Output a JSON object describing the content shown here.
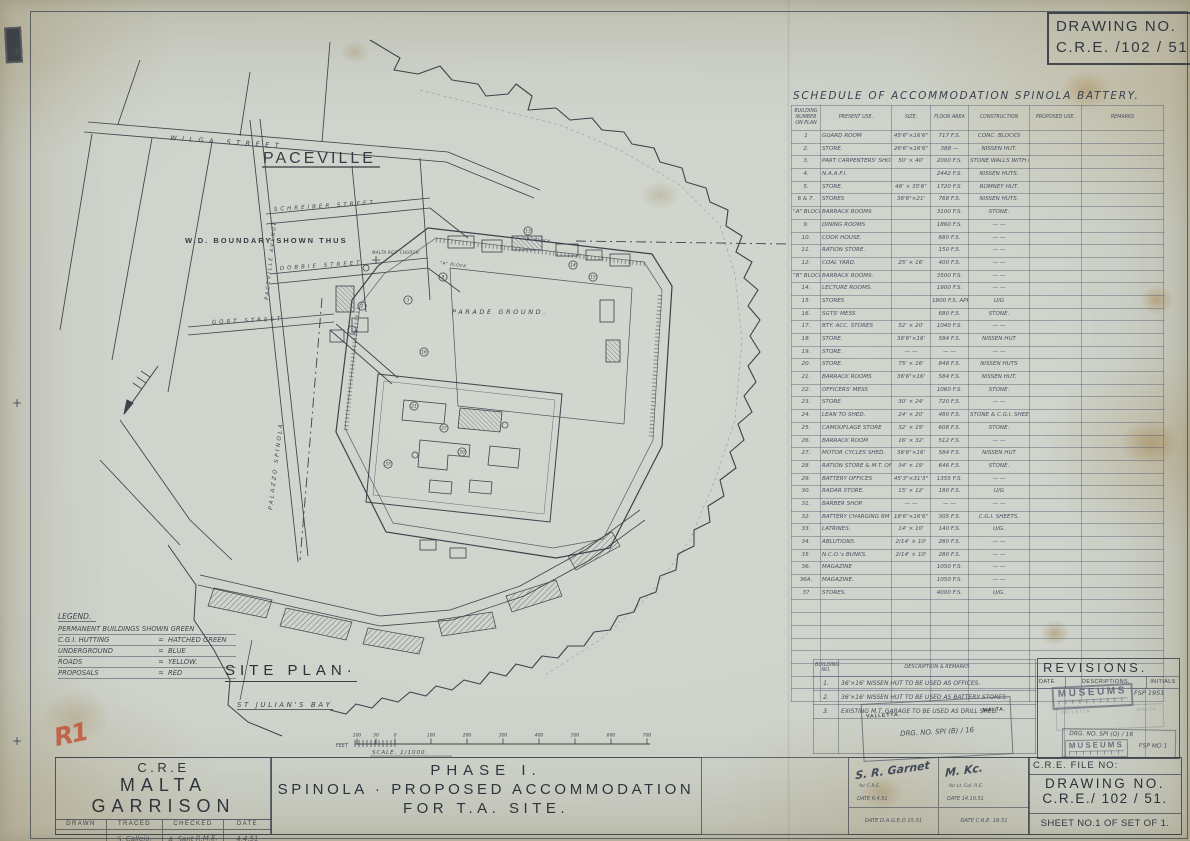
{
  "drawing_no_header": {
    "line1": "DRAWING NO.",
    "line2": "C.R.E. /102 / 51."
  },
  "schedule": {
    "title": "SCHEDULE OF ACCOMMODATION SPINOLA BATTERY.",
    "columns": [
      "BUILDING NUMBER ON PLAN",
      "PRESENT USE.",
      "SIZE.",
      "FLOOR AREA",
      "CONSTRUCTION",
      "PROPOSED USE.",
      "REMARKS"
    ],
    "rows": [
      {
        "n": "1",
        "u": "GUARD ROOM",
        "s": "45'6\"×16'6\"",
        "a": "717 F.S.",
        "c": "CONC. BLOCKS"
      },
      {
        "n": "2.",
        "u": "STORE.",
        "s": "26'6\"×16'6\"",
        "a": "388  —",
        "c": "NISSEN HUT."
      },
      {
        "n": "3.",
        "u": "PART CARPENTERS' SHOP & PART CUBICLES",
        "s": "50' × 40'",
        "a": "2000 F.S.",
        "c": "STONE WALLS WITH C.G.I. SHEETS ROOF"
      },
      {
        "n": "4.",
        "u": "N.A.A.F.I.",
        "s": "",
        "a": "2442 F.S.",
        "c": "NISSEN HUTS."
      },
      {
        "n": "5.",
        "u": "STORE.",
        "s": "48' × 35'6\"",
        "a": "1720 F.S.",
        "c": "ROMNEY HUT."
      },
      {
        "n": "6 & 7.",
        "u": "STORES",
        "s": "36'6\"×21'",
        "a": "768 F.S.",
        "c": "NISSEN HUTS."
      },
      {
        "n": "\"A\" BLOCK 8.",
        "u": "BARRACK ROOMS",
        "s": "",
        "a": "3100 F.S.",
        "c": "STONE."
      },
      {
        "n": "9.",
        "u": "DINING ROOMS",
        "s": "",
        "a": "1860 F.S.",
        "c": "— —"
      },
      {
        "n": "10.",
        "u": "COOK HOUSE.",
        "s": "",
        "a": "680 F.S.",
        "c": "— —"
      },
      {
        "n": "11.",
        "u": "RATION STORE.",
        "s": "",
        "a": "150 F.S.",
        "c": "— —"
      },
      {
        "n": "12.",
        "u": "COAL YARD.",
        "s": "25' × 16'",
        "a": "400 F.S.",
        "c": "— —"
      },
      {
        "n": "\"B\" BLOCK 13.",
        "u": "BARRACK ROOMS.",
        "s": "",
        "a": "3500 F.S.",
        "c": "— —"
      },
      {
        "n": "14.",
        "u": "LECTURE ROOMS.",
        "s": "",
        "a": "1900 F.S.",
        "c": "— —"
      },
      {
        "n": "15.",
        "u": "STORES",
        "s": "",
        "a": "1800 F.S. APPROX.",
        "c": "U/G"
      },
      {
        "n": "16.",
        "u": "SGTS' MESS",
        "s": "",
        "a": "680 F.S.",
        "c": "STONE."
      },
      {
        "n": "17.",
        "u": "BTY. ACC. STORES",
        "s": "52' × 20'",
        "a": "1040 F.S.",
        "c": "— —"
      },
      {
        "n": "18.",
        "u": "STORE.",
        "s": "36'6\"×16'",
        "a": "584 F.S.",
        "c": "NISSEN HUT"
      },
      {
        "n": "19.",
        "u": "STORE.",
        "s": "— —",
        "a": "— —",
        "c": "— —"
      },
      {
        "n": "20.",
        "u": "STORE.",
        "s": "75' × 16'",
        "a": "848 F.S.",
        "c": "NISSEN HUTS"
      },
      {
        "n": "21.",
        "u": "BARRACK ROOMS",
        "s": "36'6\"×16'",
        "a": "584 F.S.",
        "c": "NISSEN HUT."
      },
      {
        "n": "22.",
        "u": "OFFICERS' MESS",
        "s": "",
        "a": "1060 F.S.",
        "c": "STONE."
      },
      {
        "n": "23.",
        "u": "STORE.",
        "s": "30' × 24'",
        "a": "720 F.S.",
        "c": "— —"
      },
      {
        "n": "24.",
        "u": "LEAN TO SHED.",
        "s": "24' × 20'",
        "a": "480 F.S.",
        "c": "STONE & C.G.I. SHEETS"
      },
      {
        "n": "25.",
        "u": "CAMOUFLAGE STORE",
        "s": "32' × 19'",
        "a": "608 F.S.",
        "c": "STONE."
      },
      {
        "n": "26.",
        "u": "BARRACK ROOM",
        "s": "16' × 32'",
        "a": "512 F.S.",
        "c": "— —"
      },
      {
        "n": "27.",
        "u": "MOTOR CYCLES SHED.",
        "s": "36'6\"×16'",
        "a": "584 F.S.",
        "c": "NISSEN HUT"
      },
      {
        "n": "28.",
        "u": "RATION STORE & M.T. OFF.",
        "s": "34' × 19'",
        "a": "646 F.S.",
        "c": "STONE."
      },
      {
        "n": "29.",
        "u": "BATTERY OFFICES",
        "s": "45'3\"×31'3\"",
        "a": "1355 F.S.",
        "c": "— —"
      },
      {
        "n": "30.",
        "u": "RADAR STORE.",
        "s": "15' × 12'",
        "a": "180 F.S.",
        "c": "U/G"
      },
      {
        "n": "31.",
        "u": "BARBER SHOP.",
        "s": "— —",
        "a": "— —",
        "c": "— —"
      },
      {
        "n": "32.",
        "u": "BATTERY CHARGING RM",
        "s": "18'6\"×16'6\"",
        "a": "305 F.S.",
        "c": "C.G.I. SHEETS."
      },
      {
        "n": "33.",
        "u": "LATRINES.",
        "s": "14' × 10'",
        "a": "140 F.S.",
        "c": "U/G."
      },
      {
        "n": "34.",
        "u": "ABLUTIONS.",
        "s": "2/14' × 10'",
        "a": "280 F.S.",
        "c": "— —"
      },
      {
        "n": "35.",
        "u": "N.C.O.'s BUNKS.",
        "s": "2/14' × 10'",
        "a": "280 F.S.",
        "c": "— —"
      },
      {
        "n": "36.",
        "u": "MAGAZINE",
        "s": "",
        "a": "1050 F.S.",
        "c": "— —"
      },
      {
        "n": "36A.",
        "u": "MAGAZINE.",
        "s": "",
        "a": "1050 F.S.",
        "c": "— —"
      },
      {
        "n": "37",
        "u": "STORES.",
        "s": "",
        "a": "4000 F.S.",
        "c": "U/G."
      }
    ],
    "empty_rows": 8
  },
  "remarks_table": {
    "columns": [
      "BUILDING NO.",
      "DESCRIPTION  &  REMARKS"
    ],
    "rows": [
      {
        "n": "1.",
        "d": "36'×16' NISSEN HUT TO BE USED AS OFFICES."
      },
      {
        "n": "2.",
        "d": "36'×16' NISSEN HUT TO BE USED AS BATTERY STORES."
      },
      {
        "n": "3.",
        "d": "EXISTING M.T. GARAGE TO BE USED AS DRILL SHED."
      }
    ]
  },
  "revisions": {
    "title": "REVISIONS.",
    "columns": [
      "DATE",
      "DESCRIPTIONS.",
      "INITIALS"
    ]
  },
  "stamps": {
    "museums": "MUSEUMS",
    "note1": "FSP 1951",
    "note2": "FSP MO 1",
    "drg_no_revisions": "DRG. NO.  SPI (O) / 16",
    "drg_no_box": "DRG. NO.  SPI (B) / 16",
    "valletta": "VALLETTA.",
    "malta": "MALTA."
  },
  "legend": {
    "title": "LEGEND.",
    "rows": [
      {
        "t": "PERMANENT BUILDINGS SHOWN GREEN",
        "v": ""
      },
      {
        "t": "C.G.I. HUTTING",
        "v": "HATCHED GREEN"
      },
      {
        "t": "UNDERGROUND",
        "v": "BLUE"
      },
      {
        "t": "ROADS",
        "v": "YELLOW."
      },
      {
        "t": "PROPOSALS",
        "v": "RED"
      }
    ]
  },
  "map": {
    "labels": {
      "paceville": "PACEVILLE",
      "wilga": "WILGA  STREET",
      "schreiber": "SCHREIBER  STREET",
      "dobbie": "DOBBIE  STREET",
      "gort": "GORT  STREET",
      "avenue": "PACEVILLE  AVENUE",
      "wd_boundary": "W.D.  BOUNDARY  SHOWN  THUS",
      "palazzo": "PALAZZO  SPINOLA",
      "parade": "PARADE  GROUND.",
      "a_block": "\"A\" BLOCK",
      "b_block": "\"B\" BLOCK",
      "church": "MALTA RGT. CHURCH",
      "site_plan": "SITE PLAN·",
      "bay": "ST JULIAN'S BAY",
      "red_note": "R1"
    },
    "markers": [
      {
        "n": "1",
        "x": 352,
        "y": 330
      },
      {
        "n": "2",
        "x": 362,
        "y": 306
      },
      {
        "n": "3",
        "x": 408,
        "y": 300
      },
      {
        "n": "8",
        "x": 443,
        "y": 277
      },
      {
        "n": "13",
        "x": 528,
        "y": 231
      },
      {
        "n": "14",
        "x": 573,
        "y": 265
      },
      {
        "n": "15",
        "x": 593,
        "y": 277
      },
      {
        "n": "16",
        "x": 424,
        "y": 352
      },
      {
        "n": "21",
        "x": 414,
        "y": 406
      },
      {
        "n": "27",
        "x": 444,
        "y": 428
      },
      {
        "n": "30",
        "x": 462,
        "y": 452
      },
      {
        "n": "37",
        "x": 388,
        "y": 464
      }
    ],
    "scale": {
      "feet": "FEET",
      "label": "SCALE.   1/1000.",
      "ticks": [
        {
          "x": 357,
          "t": "100"
        },
        {
          "x": 376,
          "t": "50"
        },
        {
          "x": 395,
          "t": "0"
        },
        {
          "x": 431,
          "t": "100"
        },
        {
          "x": 467,
          "t": "200"
        },
        {
          "x": 503,
          "t": "300"
        },
        {
          "x": 539,
          "t": "400"
        },
        {
          "x": 575,
          "t": "500"
        },
        {
          "x": 611,
          "t": "600"
        },
        {
          "x": 647,
          "t": "700"
        }
      ]
    }
  },
  "title_block": {
    "cre": "C.R.E",
    "garrison": "MALTA   GARRISON",
    "cols": [
      "DRAWN",
      "TRACED",
      "CHECKED",
      "DATE"
    ],
    "col_values": [
      "",
      "S. Calleja.",
      "A. Sant  R.M.E.",
      "4.4.51"
    ],
    "phase": "PHASE  I.",
    "title_line2": "SPINOLA · PROPOSED  ACCOMMODATION",
    "title_line3": "FOR  T.A.  SITE.",
    "file_no": "C.R.E. FILE NO:",
    "drawing_no_label": "DRAWING  NO.",
    "drawing_no_value": "C.R.E./ 102 / 51.",
    "sheet_no": "SHEET  NO.1 OF SET OF 1.",
    "sig_a_name": "S. R. Garnet",
    "sig_a_note": "for  C.R.E.",
    "sig_a_date": "DATE  6.4.51",
    "sig_b_name": "M. Kc.",
    "sig_b_note": "for  Lt. Col.  R.E.",
    "sig_b_date": "DATE  14.10.51",
    "sig_c": "DATE      D.A.G.E.O      15.51",
    "sig_d": "DATE      C.R.E.      18.51"
  }
}
